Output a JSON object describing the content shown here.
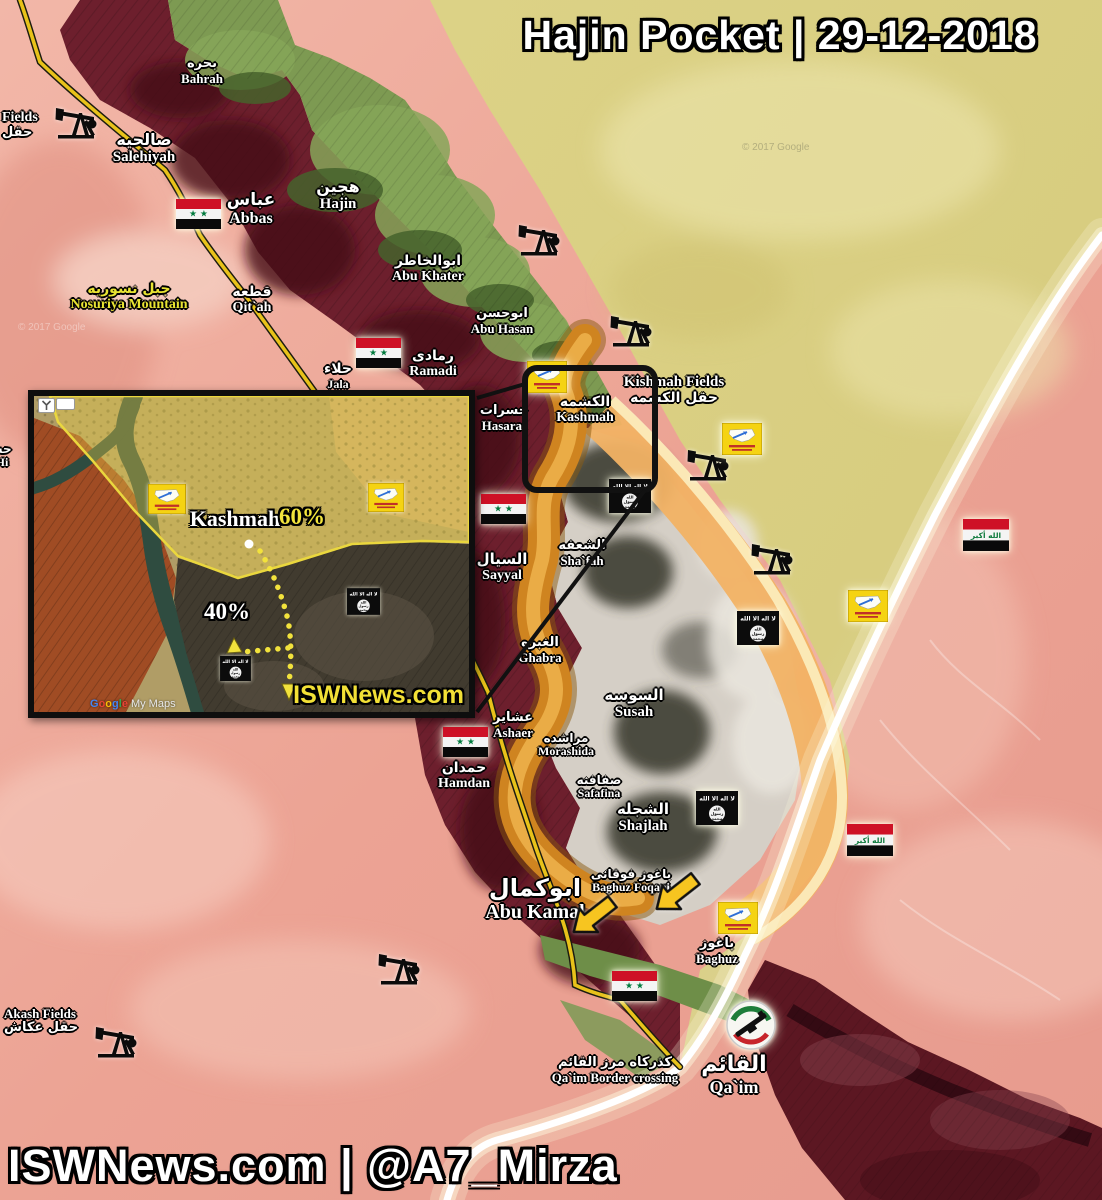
{
  "header": {
    "title": "Hajin Pocket | 29-12-2018"
  },
  "footer": {
    "credit": "ISWNews.com | @A7_Mirza"
  },
  "attribution": {
    "google_map": "© 2017 Google"
  },
  "icons": {
    "isis_flag_text": "لا اله الا الله",
    "isis_seal_line1": "الله",
    "isis_seal_line2": "رسول",
    "isis_seal_line3": "محمد",
    "iraq_flag_text": "الله أكبر",
    "syria_stars": "★ ★"
  },
  "map": {
    "places": [
      {
        "ar": "بحره",
        "en": "Bahrah",
        "x": 202,
        "y": 57,
        "s": 13,
        "e": 13
      },
      {
        "ar": "صالحيه",
        "en": "Salehiyah",
        "x": 144,
        "y": 132,
        "s": 16,
        "e": 15
      },
      {
        "ar": "عباس",
        "en": "Abbas",
        "x": 251,
        "y": 192,
        "s": 17,
        "e": 16
      },
      {
        "ar": "هجين",
        "en": "Hajin",
        "x": 338,
        "y": 179,
        "s": 16,
        "e": 15
      },
      {
        "ar": "ابوالخاطر",
        "en": "Abu Khater",
        "x": 428,
        "y": 254,
        "s": 14,
        "e": 14
      },
      {
        "ar": "ابوحسن",
        "en": "Abu Hasan",
        "x": 502,
        "y": 307,
        "s": 13,
        "e": 13
      },
      {
        "ar": "قطعه",
        "en": "Qit`ah",
        "x": 252,
        "y": 285,
        "s": 14,
        "e": 14
      },
      {
        "ar": "رمادى",
        "en": "Ramadi",
        "x": 433,
        "y": 349,
        "s": 14,
        "e": 14
      },
      {
        "ar": "حلاء",
        "en": "Jala",
        "x": 338,
        "y": 362,
        "s": 14,
        "e": 12
      },
      {
        "ar": "حسرات",
        "en": "Hasarat",
        "x": 504,
        "y": 404,
        "s": 13,
        "e": 13
      },
      {
        "ar": "الكشمه",
        "en": "Kashmah",
        "x": 585,
        "y": 395,
        "s": 14,
        "e": 14
      },
      {
        "ar": "السيال",
        "en": "Sayyal",
        "x": 502,
        "y": 552,
        "s": 15,
        "e": 14
      },
      {
        "ar": "الشعفه",
        "en": "Sha`fah",
        "x": 582,
        "y": 539,
        "s": 13,
        "e": 13
      },
      {
        "ar": "الغبره",
        "en": "Ghabra",
        "x": 540,
        "y": 636,
        "s": 13,
        "e": 13
      },
      {
        "ar": "السوسه",
        "en": "Susah",
        "x": 634,
        "y": 688,
        "s": 15,
        "e": 15
      },
      {
        "ar": "مراشده",
        "en": "Morashida",
        "x": 566,
        "y": 732,
        "s": 12,
        "e": 12
      },
      {
        "ar": "عشاير",
        "en": "Ashaer",
        "x": 513,
        "y": 711,
        "s": 13,
        "e": 13
      },
      {
        "ar": "حمدان",
        "en": "Hamdan",
        "x": 464,
        "y": 761,
        "s": 14,
        "e": 14
      },
      {
        "ar": "صفافنه",
        "en": "Safafina",
        "x": 599,
        "y": 774,
        "s": 12,
        "e": 12
      },
      {
        "ar": "الشجله",
        "en": "Shajlah",
        "x": 643,
        "y": 802,
        "s": 15,
        "e": 15
      },
      {
        "ar": "باغوز فوقانى",
        "en": "Baghuz Foqani",
        "x": 631,
        "y": 868,
        "s": 12,
        "e": 12
      },
      {
        "ar": "ابوكمال",
        "en": "Abu Kamal",
        "x": 535,
        "y": 876,
        "s": 24,
        "e": 20
      },
      {
        "ar": "باغوز",
        "en": "Baghuz",
        "x": 717,
        "y": 937,
        "s": 13,
        "e": 13
      },
      {
        "ar": "القائم",
        "en": "Qa`im",
        "x": 734,
        "y": 1054,
        "s": 22,
        "e": 18
      },
      {
        "ar": "كذركاه مرز القائم",
        "en": "Qa`im Border crossing",
        "x": 615,
        "y": 1056,
        "s": 13,
        "e": 13
      },
      {
        "ar": "جبل نسوريه",
        "en": "Nosuriya Mountain",
        "x": 129,
        "y": 282,
        "s": 14,
        "e": 14,
        "color": "#e8e332"
      },
      {
        "en": "Kishmah Fields",
        "ar": "حقل الكشمه",
        "x": 674,
        "y": 374,
        "s": 14,
        "e": 15,
        "enFirst": true
      },
      {
        "en": "Fields",
        "ar": "حقل",
        "x": 2,
        "y": 110,
        "s": 13,
        "e": 14,
        "enFirst": true,
        "align": "left"
      },
      {
        "en": "Akash Fields",
        "ar": "حقل عكاش",
        "x": 4,
        "y": 1006,
        "s": 13,
        "e": 13,
        "enFirst": true,
        "align": "left"
      },
      {
        "en": "h Hi",
        "ar": "حس",
        "x": -14,
        "y": 443,
        "s": 12,
        "e": 12,
        "align": "left"
      }
    ],
    "flags": [
      {
        "type": "syria",
        "x": 176,
        "y": 199
      },
      {
        "type": "syria",
        "x": 356,
        "y": 338
      },
      {
        "type": "syria",
        "x": 481,
        "y": 494
      },
      {
        "type": "syria",
        "x": 443,
        "y": 727
      },
      {
        "type": "syria",
        "x": 612,
        "y": 971
      },
      {
        "type": "iraq",
        "x": 963,
        "y": 519
      },
      {
        "type": "iraq",
        "x": 847,
        "y": 824
      },
      {
        "type": "isis",
        "x": 609,
        "y": 479
      },
      {
        "type": "isis",
        "x": 737,
        "y": 611
      },
      {
        "type": "isis",
        "x": 696,
        "y": 791
      },
      {
        "type": "sdf",
        "x": 527,
        "y": 361
      },
      {
        "type": "sdf",
        "x": 722,
        "y": 423
      },
      {
        "type": "sdf",
        "x": 848,
        "y": 590
      },
      {
        "type": "sdf",
        "x": 718,
        "y": 902
      },
      {
        "type": "pmu",
        "x": 725,
        "y": 999
      }
    ],
    "pumpjacks": [
      {
        "x": 55,
        "y": 102
      },
      {
        "x": 518,
        "y": 219
      },
      {
        "x": 610,
        "y": 310
      },
      {
        "x": 687,
        "y": 444
      },
      {
        "x": 751,
        "y": 538
      },
      {
        "x": 378,
        "y": 948
      },
      {
        "x": 95,
        "y": 1021
      }
    ],
    "arrows": [
      {
        "x": 651,
        "y": 876,
        "rot": -38
      },
      {
        "x": 568,
        "y": 899,
        "rot": -38
      }
    ]
  },
  "inset": {
    "title": "Kashmah",
    "pct_top": "60%",
    "pct_bottom": "40%",
    "watermark": "ISWNews.com",
    "google": "Google",
    "mymaps": "My Maps",
    "flags": [
      {
        "type": "sdf",
        "x": 114,
        "y": 88,
        "w": 38
      },
      {
        "type": "sdf",
        "x": 334,
        "y": 87,
        "w": 36
      },
      {
        "type": "isis",
        "x": 313,
        "y": 192,
        "w": 33
      },
      {
        "type": "isis",
        "x": 186,
        "y": 260,
        "w": 31
      }
    ]
  }
}
